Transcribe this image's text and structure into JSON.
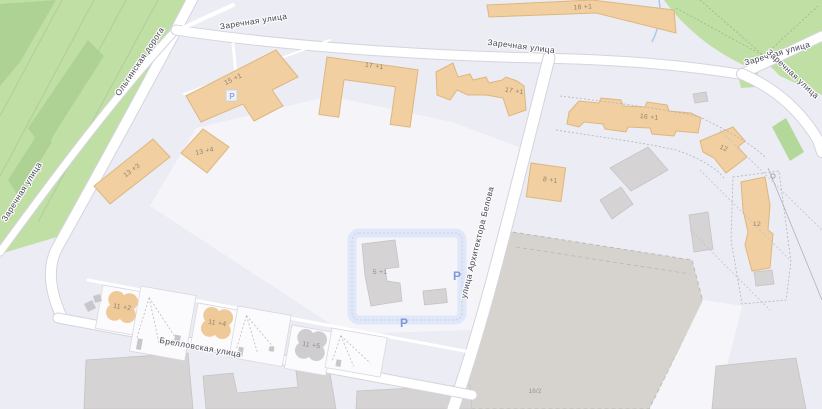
{
  "map": {
    "streets": {
      "olginskaya": "Ольгинская дорога",
      "zarechnaya": "Заречная улица",
      "belova": "улица Архитектора Белова",
      "brellovskaya": "Брелловская улица"
    },
    "buildings": {
      "b15_1": "15 +1",
      "b13_3": "13 +3",
      "b13_4": "13 +4",
      "b17_1a": "17 +1",
      "b17_1b": "17 +1",
      "b18_1": "18 +1",
      "b16_1": "16 +1",
      "b12a": "12",
      "b12b": "12",
      "b8_1": "8 +1",
      "b5_1": "5 +1",
      "b11_2": "11 +2",
      "b11_4": "11 +4",
      "b11_5": "11 +5",
      "b16_2": "16/2"
    },
    "symbols": {
      "parking": "P"
    },
    "colors": {
      "residential": "#ececf4",
      "courtyard": "#f4f4f9",
      "green": "#c0dfa5",
      "green_dark": "#aed293",
      "building_fill": "#f1cfa0",
      "building_stroke": "#ddb77f",
      "building_gray_fill": "#d5d3d4",
      "construction": "#d6d3cf",
      "road": "#ffffff",
      "road_casing": "#d4d4de",
      "parking_blue": "#7d99d7",
      "parking_area": "#dfe7f8",
      "street_text": "#45454f",
      "building_text": "#8f8274"
    }
  }
}
